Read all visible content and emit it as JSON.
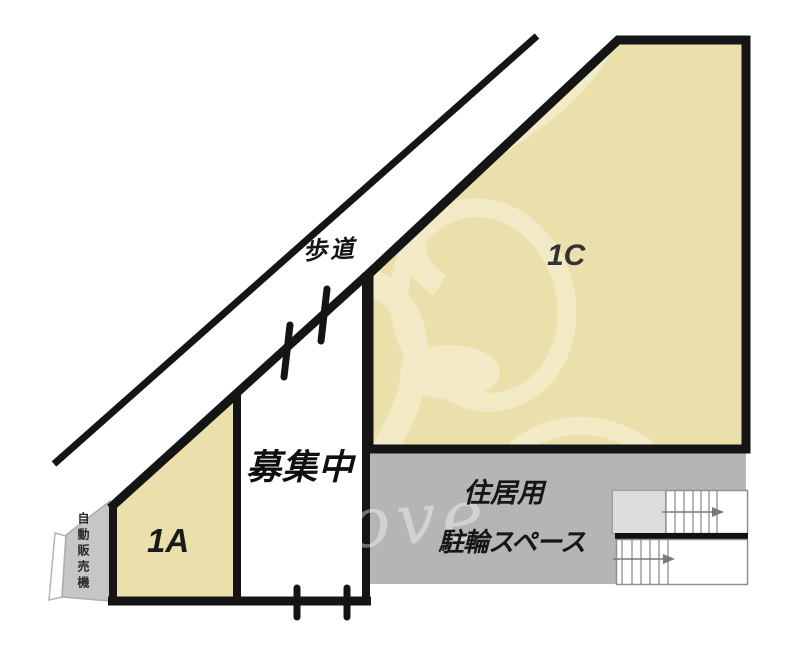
{
  "plan": {
    "sidewalk_label": "歩道",
    "unit_1c_label": "1C",
    "unit_1a_label": "1A",
    "vacancy_label": "募集中",
    "bicycle_area_label_line1": "住居用",
    "bicycle_area_label_line2": "駐輪スペース",
    "vending_machine_label": "自動販売機",
    "watermark_text": "ove"
  },
  "colors": {
    "unit_fill": "#ebdfab",
    "bicycle_area_fill": "#b5b5b5",
    "vending_fill": "#c6c6c6",
    "stair_landing_fill": "#dcdcdc",
    "watermark_tint": "#f4ecca",
    "outline": "#151515"
  }
}
